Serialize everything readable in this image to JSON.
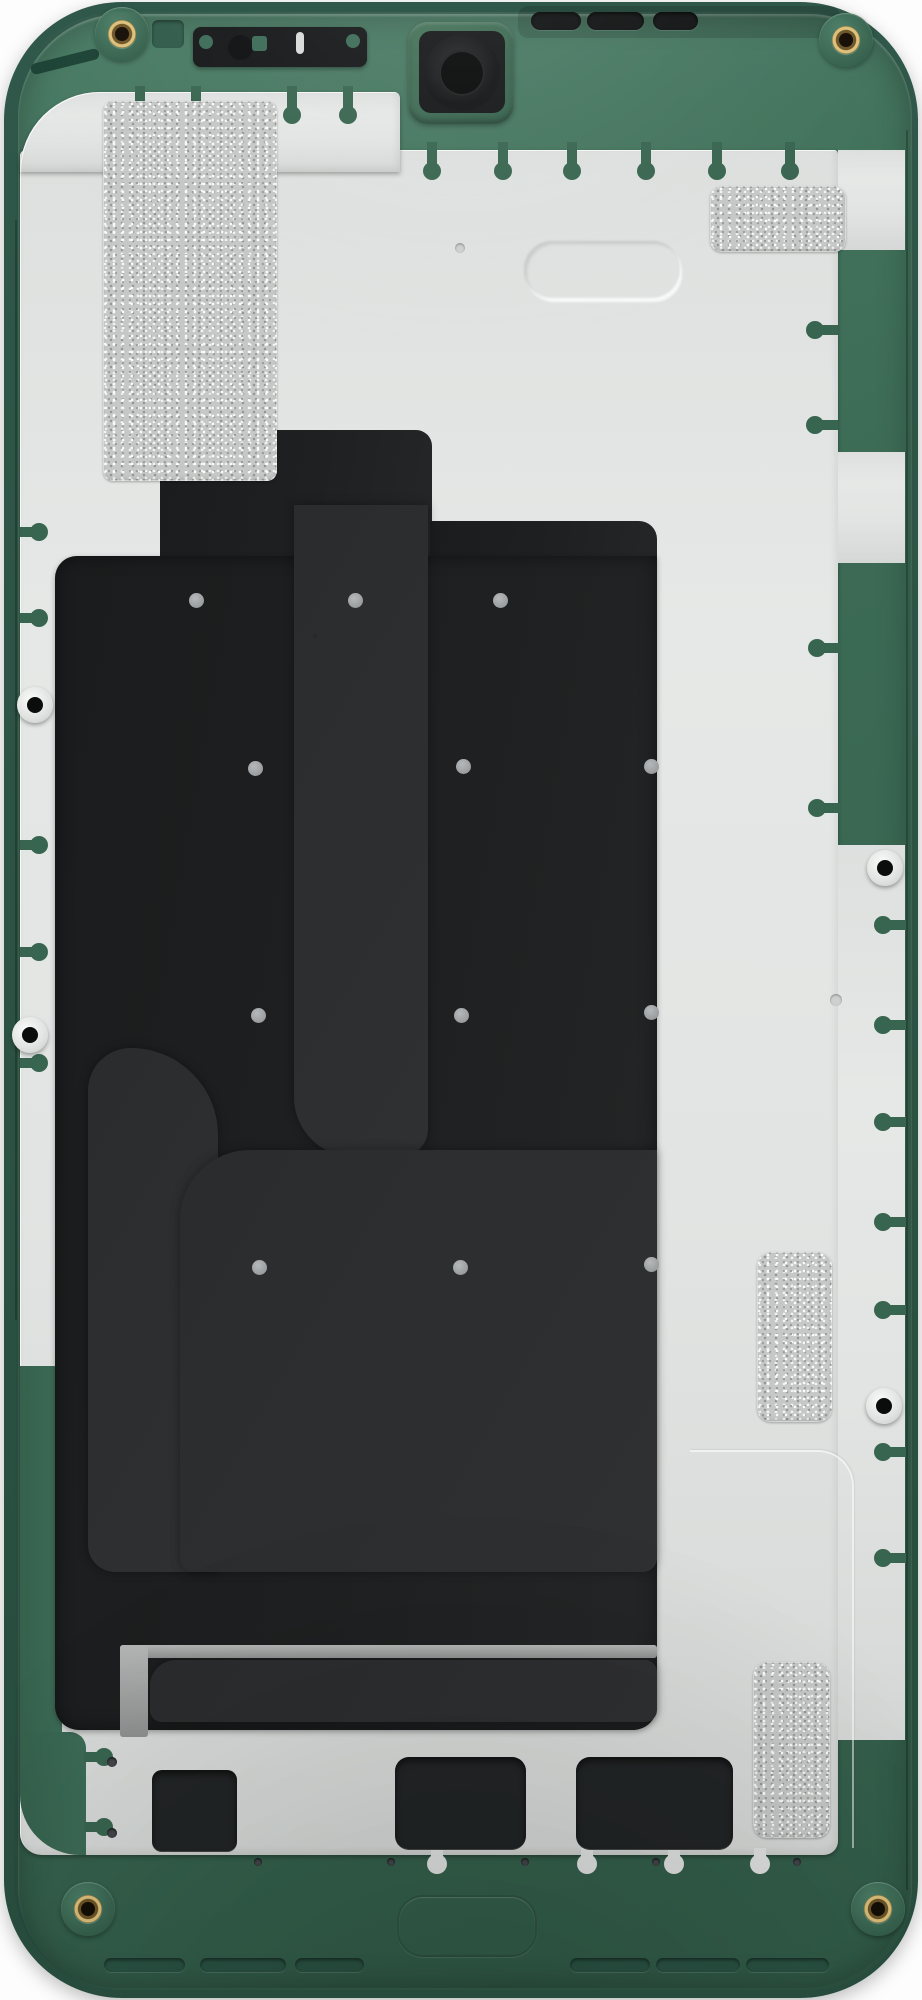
{
  "subject": "smartphone-display-assembly-internal-rear-view",
  "marking": {
    "frame_code": "AVY–1"
  },
  "colors": {
    "frame_green": "#3f6f5a",
    "frame_green_dark": "#2c5546",
    "plate": "#e2e4e3",
    "panel": "#1c1e1f",
    "flex": "#2b2d2f",
    "metal": "#a8aba9",
    "gold": "#b29552",
    "brass": "#c2a35e",
    "qr_bg": "#ebecea",
    "qr_fg": "#26282a",
    "dot": "#9fa2a4",
    "connector": "#191b1c"
  },
  "qr": {
    "matrix": [
      "111111101011011111111",
      "100000101100101000001",
      "101110110101101011101",
      "101110100110101011101",
      "101110111011001011101",
      "100000101001101000001",
      "111111101010101111111",
      "000000011001010000000",
      "101011011010110110101",
      "010010100110010100110",
      "110101101011101011010",
      "001110010100011010011",
      "111001101101100101101",
      "000101010010110100110",
      "111111101101010110011",
      "100000110100101011010",
      "101110101011010100101",
      "101110110010111101100",
      "101110101101000011011",
      "100000110110101100101",
      "111111101001101010010"
    ]
  }
}
